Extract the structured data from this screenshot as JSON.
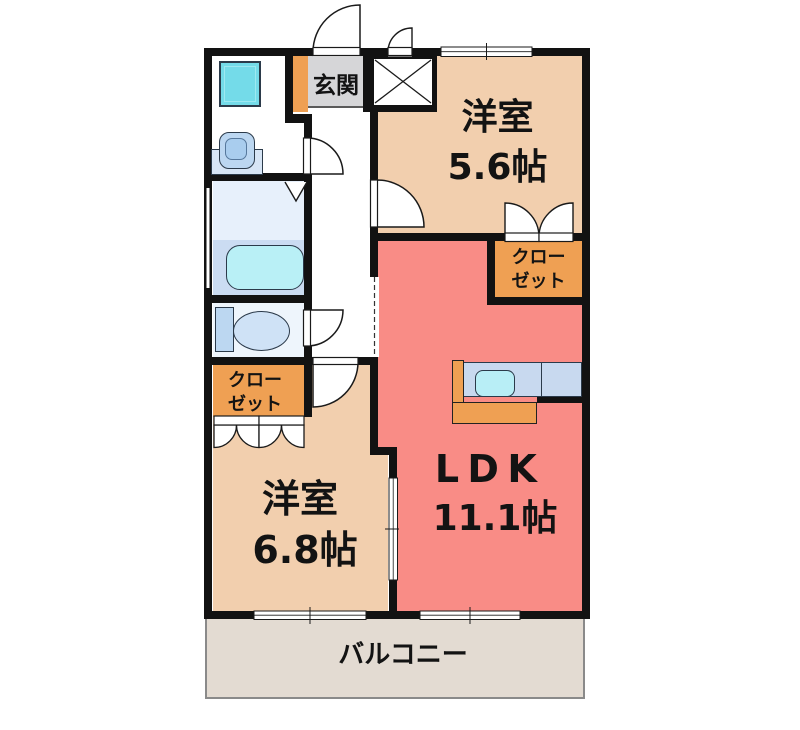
{
  "floorplan": {
    "type": "apartment-floor-plan",
    "rooms": {
      "entrance": {
        "label": "玄関"
      },
      "western_room_1": {
        "name": "洋室",
        "area": "5.6帖"
      },
      "closet_1": {
        "line1": "クロー",
        "line2": "ゼット"
      },
      "ldk": {
        "name": "LDK",
        "area": "11.1帖"
      },
      "western_room_2": {
        "name": "洋室",
        "area": "6.8帖"
      },
      "closet_2": {
        "line1": "クロー",
        "line2": "ゼット"
      },
      "balcony": {
        "label": "バルコニー"
      }
    },
    "colors": {
      "wall": "#121212",
      "western_room_floor": "#f2cfae",
      "ldk_floor": "#f98c86",
      "closet_floor": "#efa053",
      "entrance_floor": "#d6d6d8",
      "balcony_floor": "#e3dbd2",
      "bathroom_upper_floor": "#e7f0fb",
      "bathroom_lower_floor": "#cbdcf2",
      "toilet_floor": "#eef5fc",
      "bathtub": "#b9f0f6",
      "washer_pan": "#74dbe9",
      "fixture_blue": "#bcd7f1",
      "kitchen_counter_top": "#c8d9ef",
      "kitchen_sink": "#b8eef6"
    },
    "icons": [
      "washing-machine-pan-icon",
      "washbasin-icon",
      "bathtub-icon",
      "toilet-icon",
      "kitchen-counter-icon",
      "kitchen-sink-icon",
      "meter-box-icon",
      "door-swing-icon",
      "folding-door-icon",
      "sliding-door-icon",
      "window-icon"
    ]
  }
}
